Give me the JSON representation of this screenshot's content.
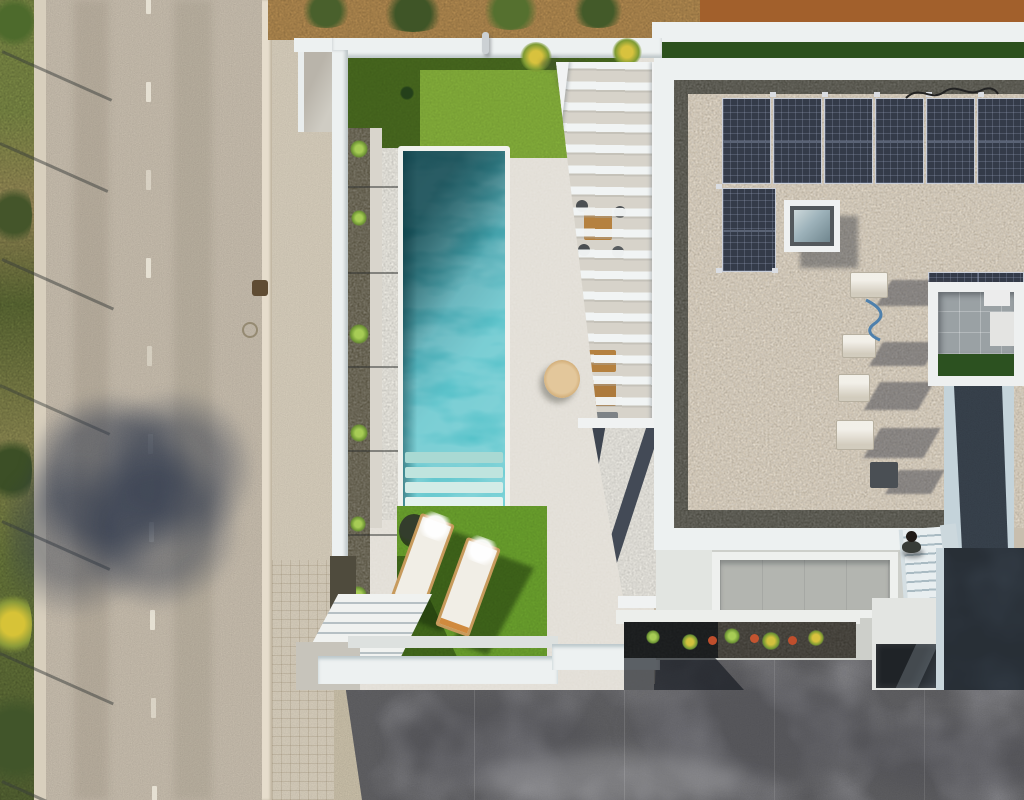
{
  "scene": {
    "type": "aerial-drone-photo",
    "description": "Top-down aerial view of a modern white villa: rectangular turquoise pool with steps, artificial grass patches, two sun loungers with towels, slatted pergola over outdoor furniture, gravel flat roof with L-shaped solar panel array, skylight, AC units, inner courtyard, staircases, a person, flower bed, asphalt street on the left and grey concrete driveway below",
    "objects": [
      "street",
      "roadside-vegetation",
      "sidewalk",
      "tree-shadow",
      "perimeter-wall",
      "swimming-pool",
      "pool-steps",
      "white-pebble-strip",
      "dark-gravel-bed",
      "artificial-grass",
      "sun-loungers",
      "outdoor-shower",
      "garden-stairs",
      "pergola",
      "outdoor-furniture",
      "parasol",
      "white-gravel-roof",
      "house-roof-gravel",
      "solar-panel-array",
      "skylight",
      "roof-cable",
      "ac-units",
      "inner-courtyard",
      "courtyard-walkway",
      "entry-porch",
      "entry-stairs",
      "person",
      "flower-bed",
      "entrance-glass",
      "concrete-driveway"
    ],
    "palette": {
      "road": "#c8beae",
      "shoulder": "#d8cfbd",
      "sidewalk": "#d6cdbb",
      "curb": "#e6ddcc",
      "vegetation": "#8d8a52",
      "dirtTop": "#b28a50",
      "dirtRed": "#a2602c",
      "wallWhite": "#edf1f1",
      "deck": "#e1ddd5",
      "grassTop": "#83ad3a",
      "grassBottom": "#6aa02d",
      "grassCourt": "#2c5120",
      "gravelDark": "#56513f",
      "pebble": "#edebe3",
      "poolCoping": "#f1f2ee",
      "poolDeep": "#10636d",
      "poolBright": "#4fc3ca",
      "roofGravel": "#d9cdb9",
      "roofBorder": "#4b4a41",
      "solar": "#343b49",
      "concrete": "#95959a",
      "soil": "#3b3831",
      "walkwayDark": "#3a444f",
      "tiles": "#9aa1a4",
      "loungerCushion": "#f1eee6",
      "loungerWood": "#c79a5c",
      "porchPad": "#b3b5b0"
    }
  }
}
